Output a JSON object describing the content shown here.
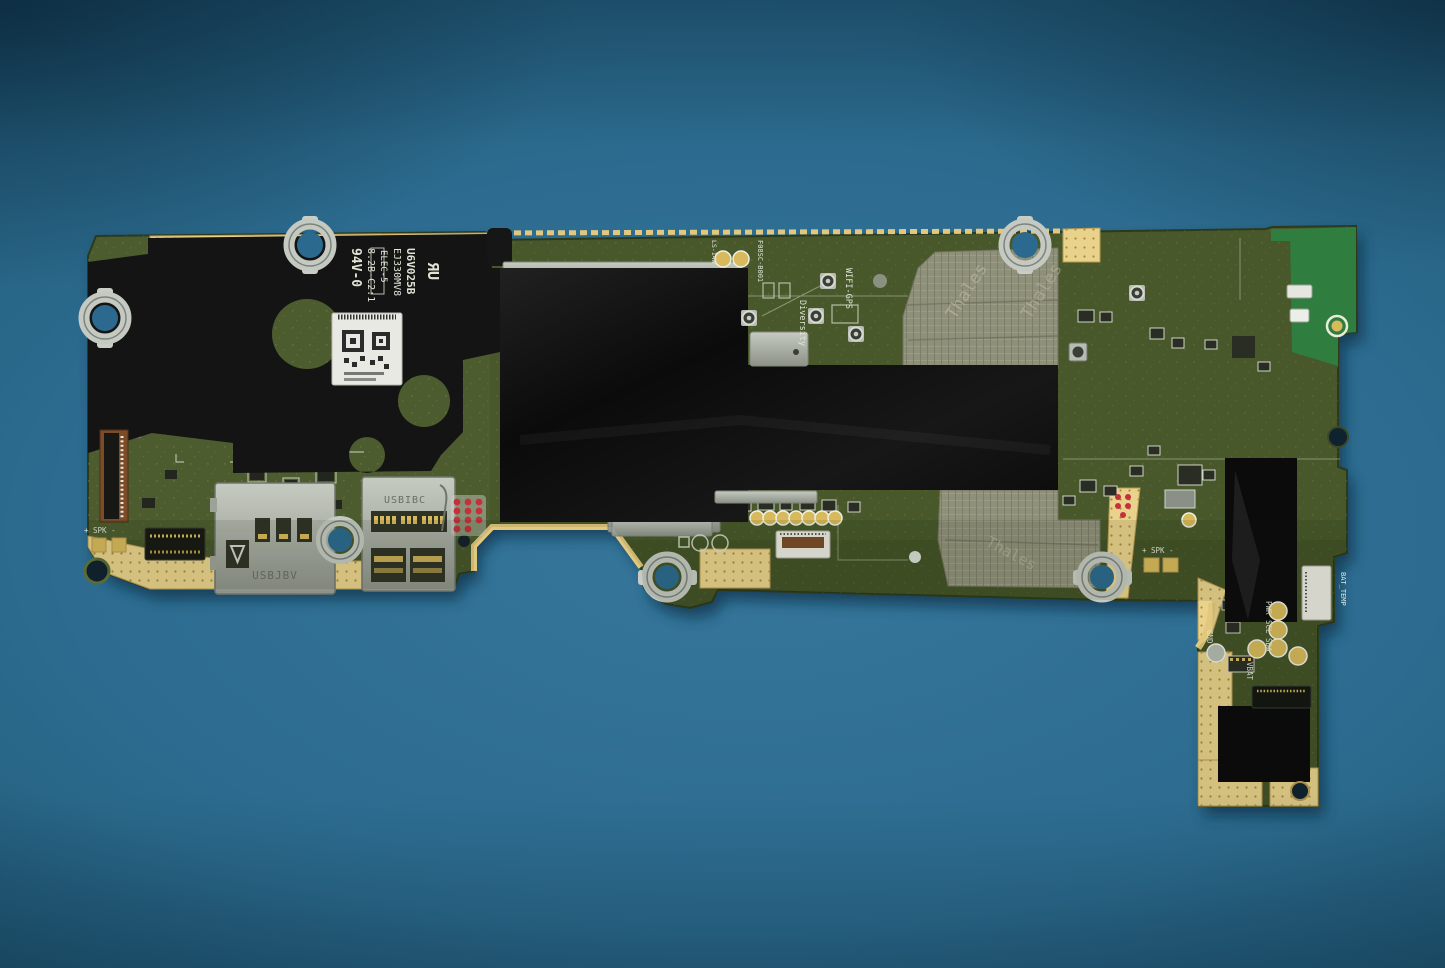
{
  "scene": {
    "subject": "tablet-motherboard-photo",
    "background": "teal-blue work surface"
  },
  "colors": {
    "background": "#2e6d92",
    "board_green": "#4c5c2e",
    "antenna_green": "#2f7d3f",
    "gold": "#e9d28c",
    "foam_black": "#131313",
    "tape_black": "#0a0a0b",
    "fabric_gray": "#8f9079",
    "metal_silver": "#bcc1ba",
    "fpc_brown": "#7c4b28",
    "red_dots": "#c5303c"
  },
  "board": {
    "silkscreen": {
      "flammability": "94V-0",
      "rev_code": "8.2B-C2:1",
      "elec_code": "ELEC-5",
      "model_code": "EJ330MV8",
      "lot_code": "U6V025B",
      "ul_mark": "ЯU",
      "wifi_gps_label": "WIFI-GPS",
      "diversity_label": "Diversity",
      "edge_code": "F08SC-B001",
      "pad_pair_label": "LS-14W",
      "speaker_left_label": "+ SPK -",
      "speaker_right_label": "+ SPK -"
    },
    "slots": {
      "sd_slot": "USBJBV",
      "sim_slot": "USBIBC"
    },
    "components": {
      "inductor": "100"
    },
    "test_points": {
      "pwr": "PWR",
      "scl": "SCL",
      "sda": "SDA",
      "vbat": "VBAT",
      "gnd": "GND",
      "bat_temp": "BAT_TEMP"
    },
    "shield_print": "Thales"
  }
}
